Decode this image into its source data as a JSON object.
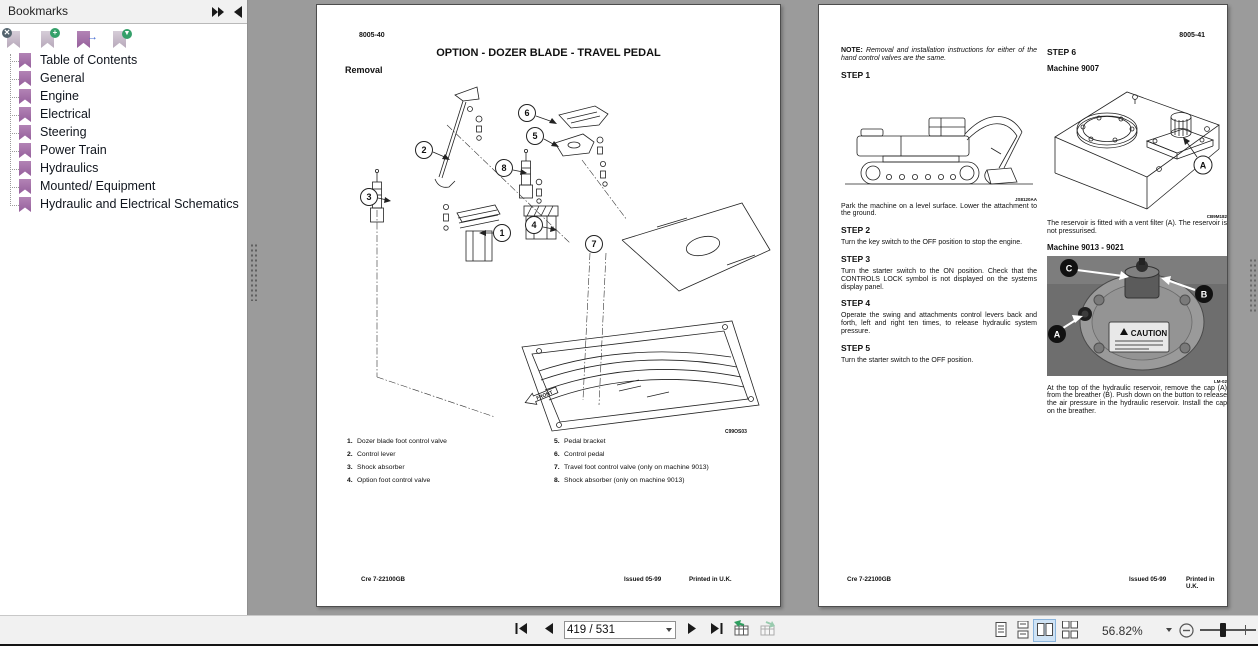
{
  "colors": {
    "bookmark_purple": "#a070a5",
    "selected_layout_highlight": "#cfe3f5",
    "canvas_gray": "#9b9b9b"
  },
  "bookmarks_panel": {
    "title": "Bookmarks",
    "toolbar_icons": [
      "delete-bookmark",
      "add-bookmark",
      "go-to-bookmark",
      "bookmark-options"
    ],
    "items": [
      "Table of Contents",
      "General",
      "Engine",
      "Electrical",
      "Steering",
      "Power Train",
      "Hydraulics",
      "Mounted/ Equipment",
      "Hydraulic and Electrical Schematics"
    ]
  },
  "left_page": {
    "page_code": "8005-40",
    "title": "OPTION - DOZER BLADE - TRAVEL PEDAL",
    "section_heading": "Removal",
    "diagram": {
      "callouts": [
        "1",
        "2",
        "3",
        "4",
        "5",
        "6",
        "7",
        "8"
      ],
      "front_label": "FRONT",
      "figure_code": "C99OS03"
    },
    "parts_col1": [
      {
        "num": "1.",
        "label": "Dozer blade foot control valve"
      },
      {
        "num": "2.",
        "label": "Control lever"
      },
      {
        "num": "3.",
        "label": "Shock absorber"
      },
      {
        "num": "4.",
        "label": "Option foot control valve"
      }
    ],
    "parts_col2": [
      {
        "num": "5.",
        "label": "Pedal bracket"
      },
      {
        "num": "6.",
        "label": "Control pedal"
      },
      {
        "num": "7.",
        "label": "Travel foot control valve (only on machine 9013)"
      },
      {
        "num": "8.",
        "label": "Shock absorber (only on machine 9013)"
      }
    ],
    "footer": {
      "ref": "Cre  7-22100GB",
      "issued": "Issued 05-99",
      "printed": "Printed in U.K."
    }
  },
  "right_page": {
    "page_code": "8005-41",
    "note_label": "NOTE:",
    "note_text": "Removal and installation instructions for either of the hand control valves are the same.",
    "steps": [
      {
        "label": "STEP 1",
        "text": "Park the machine on a level surface. Lower the attachment to the ground."
      },
      {
        "label": "STEP 2",
        "text": "Turn the key switch to the OFF position to stop the engine."
      },
      {
        "label": "STEP 3",
        "text": "Turn the starter switch to the ON position. Check that the CONTROLS LOCK symbol is not displayed on the systems display panel."
      },
      {
        "label": "STEP 4",
        "text": "Operate the swing and attachments control levers back and forth, left and right ten times, to release hydraulic system pressure."
      },
      {
        "label": "STEP 5",
        "text": "Turn the starter switch to the OFF position."
      },
      {
        "label": "STEP 6",
        "text": ""
      }
    ],
    "excavator_figure_code": "JS8120AA",
    "machine_9007_heading": "Machine 9007",
    "reservoir_figure_code": "CB9M182",
    "reservoir_text": "The reservoir is fitted with a vent filter (A). The reservoir is not pressurised.",
    "machine_9013_heading": "Machine 9013 - 9021",
    "photo_labels": {
      "a": "A",
      "b": "B",
      "c": "C"
    },
    "caution_label": "CAUTION",
    "photo_figure_code": "LM-02",
    "photo_text": "At the top of the hydraulic reservoir, remove the cap (A) from the breather (B). Push down on the button to release the air pressure in the hydraulic reservoir. Install the cap on the breather.",
    "footer": {
      "ref": "Cre  7-22100GB",
      "issued": "Issued 05-99",
      "printed": "Printed in U.K."
    }
  },
  "toolbar": {
    "page_field": "419 / 531",
    "zoom_value": "56.82%"
  }
}
